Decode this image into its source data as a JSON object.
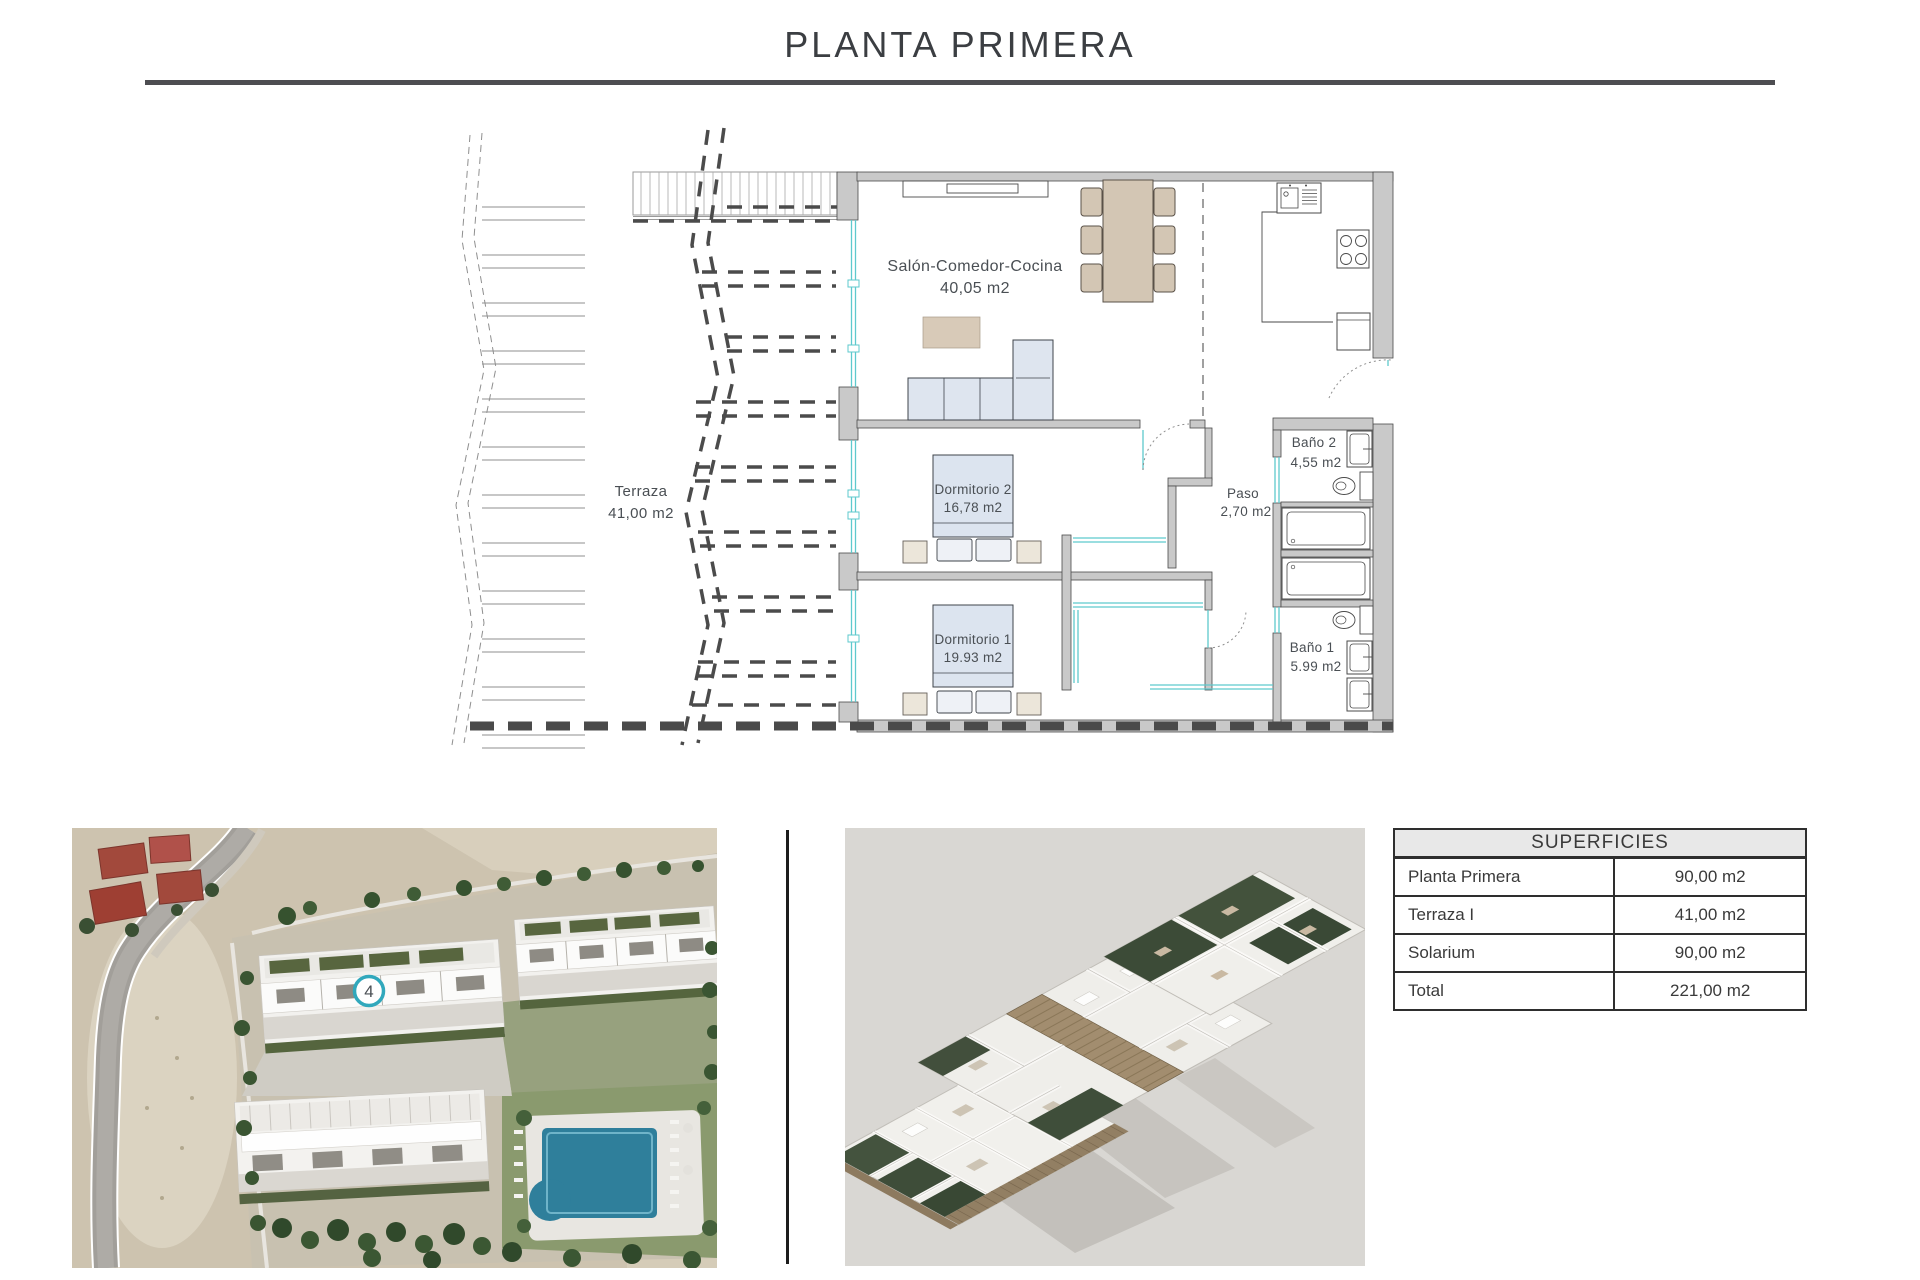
{
  "title": "PLANTA PRIMERA",
  "floor_plan": {
    "rooms": {
      "terraza": {
        "name": "Terraza",
        "area": "41,00 m2"
      },
      "salon": {
        "name": "Salón-Comedor-Cocina",
        "area": "40,05 m2"
      },
      "dormitorio2": {
        "name": "Dormitorio 2",
        "area": "16,78 m2"
      },
      "dormitorio1": {
        "name": "Dormitorio 1",
        "area": "19.93 m2"
      },
      "bano2": {
        "name": "Baño 2",
        "area": "4,55 m2"
      },
      "bano1": {
        "name": "Baño 1",
        "area": "5.99 m2"
      },
      "paso": {
        "name": "Paso",
        "area": "2,70 m2"
      }
    }
  },
  "site_photo": {
    "unit_marker": "4"
  },
  "superficies_table": {
    "header": "SUPERFICIES",
    "rows": [
      {
        "label": "Planta Primera",
        "value": "90,00 m2"
      },
      {
        "label": "Terraza I",
        "value": "41,00 m2"
      },
      {
        "label": "Solarium",
        "value": "90,00 m2"
      },
      {
        "label": "Total",
        "value": "221,00 m2"
      }
    ]
  },
  "colors": {
    "wall_gray": "#c9c9c9",
    "glass_cyan": "#5ec9cd",
    "furniture_blue": "#dee5ef",
    "furniture_tan": "#d3c6b4",
    "marker_teal": "#31a8bc"
  }
}
